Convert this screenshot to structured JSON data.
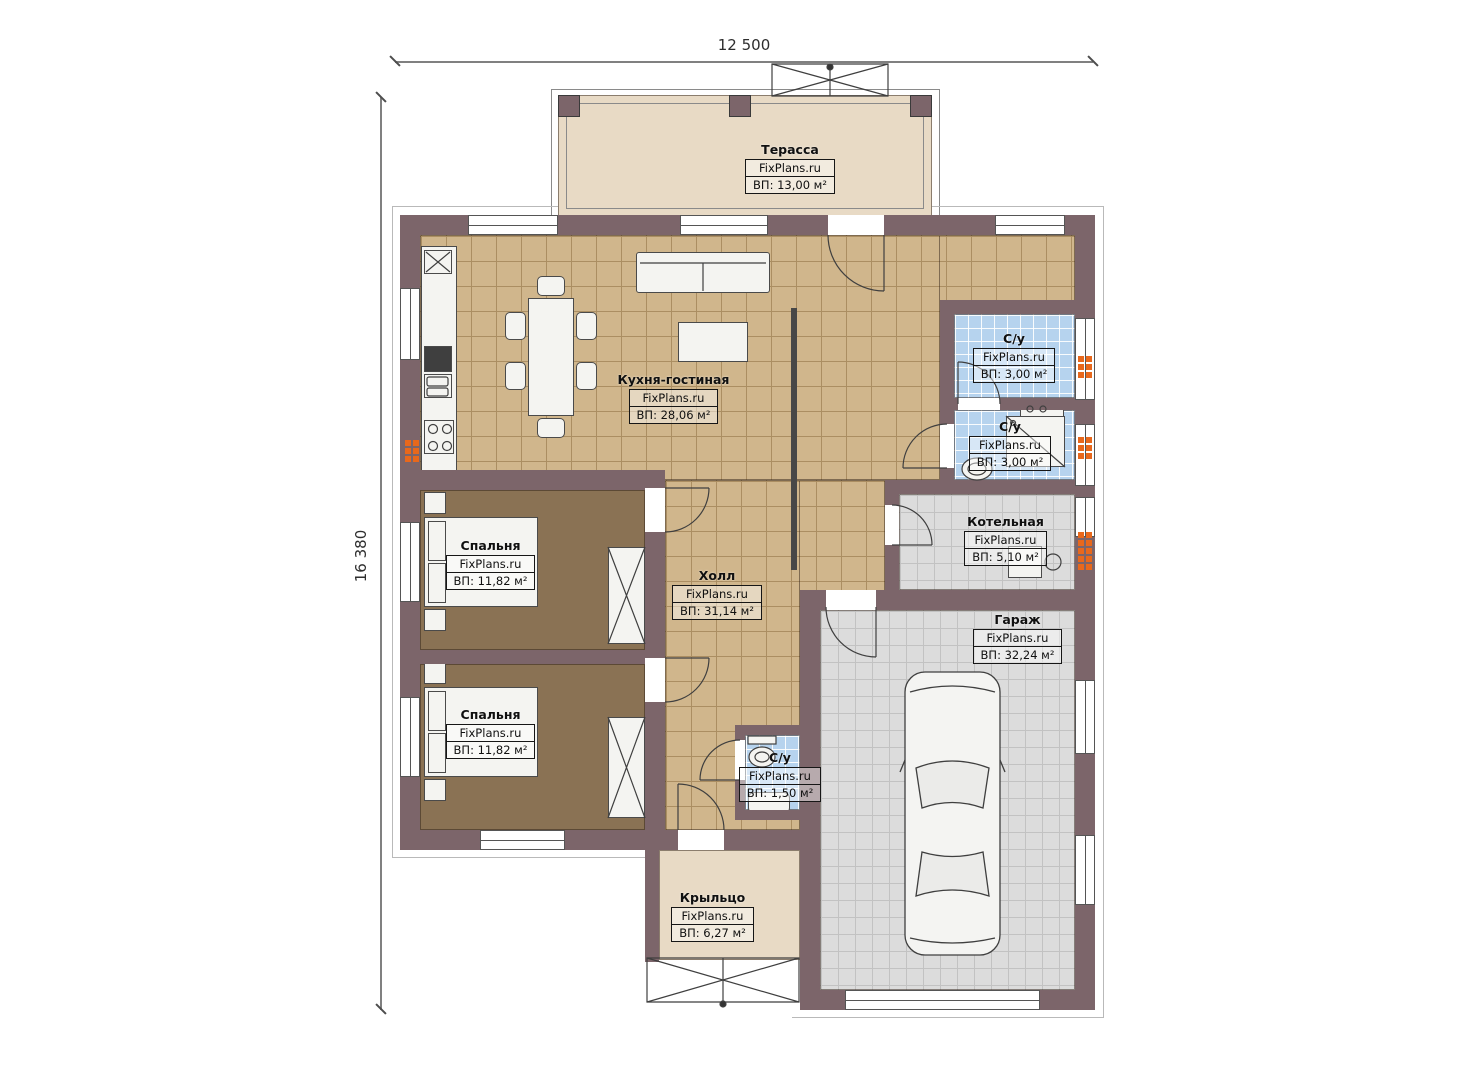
{
  "palette": {
    "wall": "#7c656a",
    "tan-floor": "#d0b68c",
    "tan-grid": "#ab8e62",
    "beige-floor": "#e8dac5",
    "brown-floor": "#8a7254",
    "blue-floor": "#b6d3ee",
    "gray-floor": "#dcdcdc",
    "radiator": "#e8681c"
  },
  "dimensions": {
    "top": "12 500",
    "left": "16 380"
  },
  "branding": "FixPlans.ru",
  "rooms": {
    "terrace": {
      "name": "Терасса",
      "area": "ВП: 13,00 м²"
    },
    "kitchen": {
      "name": "Кухня-гостиная",
      "area": "ВП: 28,06 м²"
    },
    "hall": {
      "name": "Холл",
      "area": "ВП: 31,14 м²"
    },
    "bedroom1": {
      "name": "Спальня",
      "area": "ВП: 11,82 м²"
    },
    "bedroom2": {
      "name": "Спальня",
      "area": "ВП: 11,82 м²"
    },
    "bath1": {
      "name": "С/у",
      "area": "ВП: 3,00 м²"
    },
    "bath2": {
      "name": "С/у",
      "area": "ВП: 3,00 м²"
    },
    "boiler": {
      "name": "Котельная",
      "area": "ВП: 5,10 м²"
    },
    "garage": {
      "name": "Гараж",
      "area": "ВП: 32,24 м²"
    },
    "wc": {
      "name": "С/у",
      "area": "ВП: 1,50 м²"
    },
    "porch": {
      "name": "Крыльцо",
      "area": "ВП: 6,27 м²"
    }
  }
}
